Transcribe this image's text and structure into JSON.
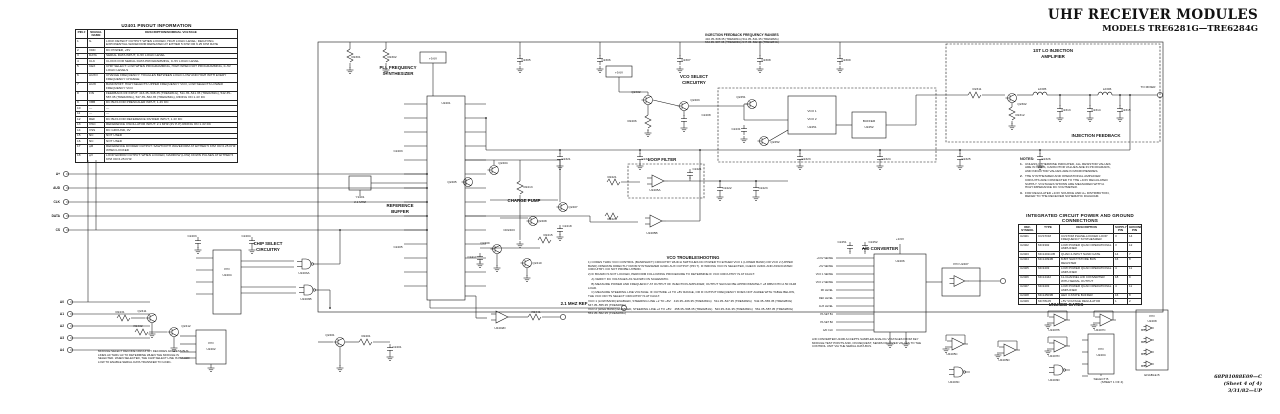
{
  "title_block": {
    "line1": "UHF RECEIVER MODULES",
    "line2": "MODELS TRE6281G—TRE6284G"
  },
  "footer": {
    "line1": "68P81088E09—C",
    "line2": "(Sheet 4 of 4)",
    "line3": "3/31/82—UP"
  },
  "pinout_table": {
    "title": "U2401 PINOUT INFORMATION",
    "columns": [
      "PIN #",
      "SIGNAL NAME",
      "DESCRIPTION/NOMINAL VOLTAGE"
    ],
    "rows": [
      [
        "1",
        "fL",
        "LOCK DETECT OUTPUT: WHEN LOCKED, HIGH LOGIC LEVEL; DECAYING EXPONENTIAL WAVEFORM REPEATED AT EITHER 5 KHZ OR 6.25 KHZ RATE"
      ],
      [
        "2",
        "VDD",
        "DC POWER, +5V"
      ],
      [
        "3",
        "DATA",
        "SERIAL DATA INPUT, 0–5V LOGIC LEVEL"
      ],
      [
        "4",
        "CLK",
        "CLOCK FOR SERIAL DATA PROGRAMMING, 0–5V LOGIC LEVEL"
      ],
      [
        "5",
        "CEX",
        "CHIP SELECT: LOW WHEN PROGRAMMING, HIGH WHEN NOT PROGRAMMING, 0–5V LOGIC LEVELS"
      ],
      [
        "6",
        "AUXO",
        "CHANGE FREQUENCY: TOGGLES BETWEEN LOGIC LOW AND HIGH WITH EVERY FREQUENCY CHANGE"
      ],
      [
        "7",
        "AUXI",
        "BANDSHIFT: HIGH SELECTS UPPER FREQUENCY VCO, LOW SELECTS LOWER FREQUENCY VCO"
      ],
      [
        "8",
        "FIN",
        "FEEDBACK RF INPUT: 416.35–508.35 (TRE6281G), 511.35–541.35 (TRE6282G), 542.35–587.35 (TRE6283G), 547.35–562.35 (TRE6284G), RIDING ON 1.4V DC"
      ],
      [
        "9",
        "VBB",
        "DC BIAS FOR PRESCALER INPUT, 1.4V DC"
      ],
      [
        "10",
        "—",
        "—"
      ],
      [
        "11",
        "—",
        "—"
      ],
      [
        "12",
        "REF",
        "DC BIAS FOR REFERENCE DIVIDER INPUT, 1.4V DC"
      ],
      [
        "13",
        "OSC",
        "REFERENCE OSCILLATOR INPUT: 2.1 MHZ (2V P-P) RIDING ON 1.4V DC"
      ],
      [
        "14",
        "VSS",
        "DC GROUND, 0V"
      ],
      [
        "15",
        "NC",
        "NOT USED"
      ],
      [
        "16",
        "NC",
        "NOT USED"
      ],
      [
        "17",
        "φR",
        "REFERENCE DIVIDER OUTPUT: SAWTOOTH WAVEFORM AT EITHER 5 KHZ OR 6.25 KHZ WHEN LOCKED"
      ],
      [
        "18",
        "φV",
        "LOOP ERROR OUTPUT: WHEN LOCKED, NARROW (LOW) DOWN PULSES AT EITHER 5 KHZ OR 6.25 KHZ"
      ]
    ]
  },
  "ic_table": {
    "title": "INTEGRATED CIRCUIT POWER AND GROUND CONNECTIONS",
    "columns": [
      "REF. SYMBOL",
      "TYPE",
      "DESCRIPTION",
      "SUPPLY PIN",
      "GROUND PIN"
    ],
    "rows": [
      [
        "U2401",
        "CUSTOM",
        "CUSTOM PHASE-LOCKED LOOP FREQUENCY SYNTHESIZER",
        "3",
        "14"
      ],
      [
        "U2402",
        "MC3302",
        "LOW POWER QUAD OPERATIONAL AMPLIFIER",
        "3",
        "12"
      ],
      [
        "U2403",
        "MC14011UB",
        "QUAD 2-INPUT NAND GATE",
        "14",
        "7"
      ],
      [
        "U2404",
        "MC14094B",
        "8-BIT SHIFT/STORE BUS REGISTER",
        "16",
        "8"
      ],
      [
        "U2405",
        "MC3403",
        "LOW POWER QUAD OPERATIONAL AMPLIFIER",
        "4",
        "11"
      ],
      [
        "U2406",
        "MC14442",
        "11-CHANNEL A/D CONVERTER WITH SERIAL OUTPUT",
        "18",
        "9"
      ],
      [
        "U2407",
        "MC3403",
        "LOW POWER QUAD OPERATIONAL AMPLIFIER",
        "4",
        "11"
      ],
      [
        "U2408",
        "MC14503B",
        "HEX 3-STATE BUFFER",
        "16",
        "8"
      ],
      [
        "U2409",
        "MC78L05",
        "+5V VOLTAGE REGULATOR",
        "1",
        "2"
      ]
    ]
  },
  "notes": {
    "title": "NOTES:",
    "items": [
      "UNLESS OTHERWISE INDICATED, ALL RESISTOR VALUES ARE IN OHMS, CAPACITOR VALUES ARE IN PICOFARADS, AND INDUCTOR VALUES ARE IN MICROHENRIES.",
      "THE SYNTHESIZER AND OPERATIONAL AMPLIFIER CIRCUITS ARE CONNECTED TO THE +9.6V REGULATED SUPPLY. VOLTAGES SHOWN ARE MEASURED WITH A HIGH IMPEDANCE DC VOLTMETER.",
      "FOR REGULATED +9.6V SOURCE AND A+ DISTRIBUTION, REFER TO THE RECEIVER SCHEMATIC DIAGRAM."
    ]
  },
  "injection_ranges": {
    "title": "INJECTION FEEDBACK FREQUENCY RANGES",
    "line1": "416.35–508.35 (TRE6281G)   511.35–541.35 (TRE6282G)",
    "line2": "542.35–587.35 (TRE6283G)   547.35–562.35 (TRE6284G)"
  },
  "vco_troubleshooting": {
    "title": "VCO TROUBLESHOOTING",
    "lines": [
      "1) CODES THRU VCO CONTROL (BANDSHIFT) CIRCUITRY WHICH SWITCHES DC POWER TO EITHER VCO 1 (LOWER BAND) OR VCO 2 (UPPER BAND) OPERATE DIRECTLY FROM SYNTHESIZER U2401 AUX OUTPUT (PIN 7). IF WRONG VCO IS SELECTED, CHECK U2401 AND ASSOCIATED CIRCUITRY. DO NOT PROBE HYBRID.",
      "2) IF BOARD IS NOT LOCKED, PERFORM FOLLOWING PROCEDURE TO DETERMINE IF VCO CIRCUITRY IS AT FAULT:",
      "    A) VERIFY DC VOLTAGES AS SHOWN ON SCHEMATIC.",
      "    B) MEASURE POWER AND FREQUENCY AT OUTPUT OF INJECTION AMPLIFIER; OUTPUT SHOULD BE APPROXIMATELY +8 DBM INTO A 50 OHM LOAD.",
      "    C) MEASURE STEERING LINE VOLTAGE. IF OUTSIDE +2 TO +8V RANGE, OR IF OUTPUT FREQUENCY DOES NOT AGREE WITH TABLE BELOW, THE VCO OR ITS SELECT CIRCUITRY IS AT FAULT.",
      "VCO 1 (LOW BAND) ENABLED, STEERING LINE +2 TO +8V:   416.35–466.35 (TRE6281G)   511.35–527.35 (TRE6282G)   542.35–565.35 (TRE6283G)   547.35–555.35 (TRE6284G)",
      "VCO 2 (HIGH BAND) ENABLED, STEERING LINE +2 TO +8V:   458.35–508.35 (TRE6281G)   523.35–541.35 (TRE6282G)   561.35–587.35 (TRE6283G)   553.35–562.35 (TRE6284G)"
    ]
  },
  "module_note": "MODULE SELECT DECODE CIRCUITRY DECODES ADDRESS BUS LINES A0 THRU A3 TO DETERMINE WHEN THE MODULE IS SELECTED. WHEN SELECTED, THE CHIP SELECT LINE IS PULLED LOW TO ENABLE SERIAL DATA TRANSFER TO U2401.",
  "adc_note": "A/D CONVERTER U2406 ACCEPTS SAMPLED ANALOG VOLTAGES FROM KEY MODULE TEST POINTS AND, ON REQUEST, SENDS DIGITIZED VALUES TO THE CONTROL UNIT VIA THE SERIAL DATA BUS.",
  "schematic": {
    "block_labels": [
      {
        "t": "PLL FREQUENCY",
        "x": 398,
        "y": 69
      },
      {
        "t": "SYNTHESIZER",
        "x": 398,
        "y": 75
      },
      {
        "t": "VCO SELECT",
        "x": 694,
        "y": 78
      },
      {
        "t": "CIRCUITRY",
        "x": 694,
        "y": 84
      },
      {
        "t": "1ST LO INJECTION",
        "x": 1053,
        "y": 52
      },
      {
        "t": "AMPLIFIER",
        "x": 1053,
        "y": 58
      },
      {
        "t": "CHARGE PUMP",
        "x": 524,
        "y": 202
      },
      {
        "t": "LOOP FILTER",
        "x": 662,
        "y": 161
      },
      {
        "t": "INJECTION FEEDBACK",
        "x": 1096,
        "y": 137
      },
      {
        "t": "REFERENCE",
        "x": 400,
        "y": 207
      },
      {
        "t": "BUFFER",
        "x": 400,
        "y": 213
      },
      {
        "t": "CHIP SELECT",
        "x": 268,
        "y": 245
      },
      {
        "t": "CIRCUITRY",
        "x": 268,
        "y": 251
      },
      {
        "t": "A/D CONVERTER",
        "x": 880,
        "y": 250
      },
      {
        "t": "UNUSED GATES",
        "x": 1066,
        "y": 306
      },
      {
        "t": "2.1 MHZ REF",
        "x": 574,
        "y": 305
      }
    ],
    "component_labels": [
      {
        "t": "C2305",
        "x": 526,
        "y": 61
      },
      {
        "t": "C2306",
        "x": 606,
        "y": 61
      },
      {
        "t": "C2307",
        "x": 686,
        "y": 61
      },
      {
        "t": "C2308",
        "x": 766,
        "y": 61
      },
      {
        "t": "C2309",
        "x": 846,
        "y": 61
      },
      {
        "t": "R2301",
        "x": 356,
        "y": 58
      },
      {
        "t": "R2302",
        "x": 392,
        "y": 58
      },
      {
        "t": "+9.6V",
        "x": 619,
        "y": 73.5
      },
      {
        "t": "+9.6V",
        "x": 433,
        "y": 59.5
      },
      {
        "t": "U2401",
        "x": 446,
        "y": 104
      },
      {
        "t": "Y2401",
        "x": 360,
        "y": 198
      },
      {
        "t": "2.1 MHZ",
        "x": 360,
        "y": 203
      },
      {
        "t": "C2403",
        "x": 398,
        "y": 152
      },
      {
        "t": "C2405",
        "x": 398,
        "y": 248
      },
      {
        "t": "Q2402",
        "x": 636,
        "y": 93
      },
      {
        "t": "Q2403",
        "x": 695,
        "y": 101
      },
      {
        "t": "R2406",
        "x": 632,
        "y": 122
      },
      {
        "t": "C2408",
        "x": 706,
        "y": 116
      },
      {
        "t": "Q2404",
        "x": 503,
        "y": 164
      },
      {
        "t": "Q2405",
        "x": 452,
        "y": 183
      },
      {
        "t": "Q2407",
        "x": 573,
        "y": 208
      },
      {
        "t": "Q2408",
        "x": 542,
        "y": 222
      },
      {
        "t": "Q2409",
        "x": 485,
        "y": 244
      },
      {
        "t": "Q2410",
        "x": 537,
        "y": 264
      },
      {
        "t": "R2413",
        "x": 528,
        "y": 188
      },
      {
        "t": "R2415",
        "x": 548,
        "y": 236
      },
      {
        "t": "CR2403",
        "x": 509,
        "y": 231
      },
      {
        "t": "C2417",
        "x": 472,
        "y": 258
      },
      {
        "t": "C2418",
        "x": 567,
        "y": 227
      },
      {
        "t": "U2405A",
        "x": 655,
        "y": 191
      },
      {
        "t": "R2421",
        "x": 612,
        "y": 178
      },
      {
        "t": "C2421",
        "x": 697,
        "y": 170
      },
      {
        "t": "C2422",
        "x": 727,
        "y": 189
      },
      {
        "t": "C2423",
        "x": 763,
        "y": 189
      },
      {
        "t": "U2405B",
        "x": 652,
        "y": 234
      },
      {
        "t": "R2424",
        "x": 612,
        "y": 220
      },
      {
        "t": "VCO 1",
        "x": 812,
        "y": 112
      },
      {
        "t": "VCO 2",
        "x": 812,
        "y": 120
      },
      {
        "t": "U2451",
        "x": 812,
        "y": 128
      },
      {
        "t": "BUFFER",
        "x": 869,
        "y": 122
      },
      {
        "t": "U2452",
        "x": 869,
        "y": 128
      },
      {
        "t": "Q2451",
        "x": 741,
        "y": 98
      },
      {
        "t": "Q2452",
        "x": 775,
        "y": 143
      },
      {
        "t": "C2431",
        "x": 736,
        "y": 130
      },
      {
        "t": "R2311",
        "x": 977,
        "y": 90
      },
      {
        "t": "Q2302",
        "x": 1022,
        "y": 105
      },
      {
        "t": "L2305",
        "x": 1042,
        "y": 90
      },
      {
        "t": "L2306",
        "x": 1107,
        "y": 90
      },
      {
        "t": "C2313",
        "x": 1066,
        "y": 111
      },
      {
        "t": "C2314",
        "x": 1096,
        "y": 111
      },
      {
        "t": "C2315",
        "x": 1126,
        "y": 111
      },
      {
        "t": "R2312",
        "x": 1020,
        "y": 116
      },
      {
        "t": "TO MIXER",
        "x": 1148,
        "y": 88
      },
      {
        "t": "C2321",
        "x": 566,
        "y": 160
      },
      {
        "t": "C2322",
        "x": 646,
        "y": 160
      },
      {
        "t": "C2323",
        "x": 806,
        "y": 160
      },
      {
        "t": "C2324",
        "x": 886,
        "y": 160
      },
      {
        "t": "C2325",
        "x": 966,
        "y": 160
      },
      {
        "t": "C2326",
        "x": 1046,
        "y": 160
      },
      {
        "t": "U2403A",
        "x": 304,
        "y": 274
      },
      {
        "t": "U2403B",
        "x": 306,
        "y": 300
      },
      {
        "t": "P/O",
        "x": 227,
        "y": 270
      },
      {
        "t": "U2404",
        "x": 227,
        "y": 276
      },
      {
        "t": "C2403",
        "x": 192,
        "y": 237
      },
      {
        "t": "C2404",
        "x": 246,
        "y": 237
      },
      {
        "t": "Q2411",
        "x": 142,
        "y": 312
      },
      {
        "t": "Q2412",
        "x": 186,
        "y": 327
      },
      {
        "t": "R2431",
        "x": 120,
        "y": 313
      },
      {
        "t": "R2432",
        "x": 138,
        "y": 327
      },
      {
        "t": "P/O",
        "x": 211,
        "y": 344
      },
      {
        "t": "U2402",
        "x": 211,
        "y": 350
      },
      {
        "t": "Q2401",
        "x": 330,
        "y": 336
      },
      {
        "t": "R2401",
        "x": 366,
        "y": 337
      },
      {
        "t": "C2401",
        "x": 397,
        "y": 348
      },
      {
        "t": "U2402D",
        "x": 500,
        "y": 329
      },
      {
        "t": "R2441",
        "x": 536,
        "y": 313
      },
      {
        "t": "U2406",
        "x": 900,
        "y": 262
      },
      {
        "t": "C2451",
        "x": 842,
        "y": 243
      },
      {
        "t": "C2452",
        "x": 873,
        "y": 243
      },
      {
        "t": "+9.6V",
        "x": 900,
        "y": 240
      },
      {
        "t": "P/O U2407",
        "x": 961,
        "y": 265
      },
      {
        "t": "U2407B",
        "x": 1054,
        "y": 331
      },
      {
        "t": "U2407C",
        "x": 1100,
        "y": 331
      },
      {
        "t": "U2407D",
        "x": 1054,
        "y": 357
      },
      {
        "t": "U2403D",
        "x": 1054,
        "y": 381
      },
      {
        "t": "P/O",
        "x": 1101,
        "y": 350
      },
      {
        "t": "U2404",
        "x": 1101,
        "y": 356
      },
      {
        "t": "SELECT B",
        "x": 1101,
        "y": 380
      },
      {
        "t": "P/O",
        "x": 1152,
        "y": 317
      },
      {
        "t": "U2408",
        "x": 1152,
        "y": 322
      },
      {
        "t": "B1",
        "x": 1143,
        "y": 331
      },
      {
        "t": "B2",
        "x": 1143,
        "y": 343
      },
      {
        "t": "B3",
        "x": 1143,
        "y": 355
      },
      {
        "t": "B4",
        "x": 1143,
        "y": 367
      },
      {
        "t": "ENABLE B",
        "x": 1152,
        "y": 376
      },
      {
        "t": "(SHEET 1 OF 4)",
        "x": 1112,
        "y": 383
      },
      {
        "t": "U2405C",
        "x": 952,
        "y": 355
      },
      {
        "t": "U2405D",
        "x": 1004,
        "y": 361
      },
      {
        "t": "U2403C",
        "x": 954,
        "y": 383
      }
    ],
    "left_terminals": [
      {
        "t": "A+",
        "y": 174
      },
      {
        "t": "AUD",
        "y": 188
      },
      {
        "t": "CLK",
        "y": 202
      },
      {
        "t": "DATA",
        "y": 216
      },
      {
        "t": "CS",
        "y": 230
      }
    ],
    "addr_terminals": [
      {
        "t": "A0",
        "y": 302
      },
      {
        "t": "A1",
        "y": 314
      },
      {
        "t": "A2",
        "y": 326
      },
      {
        "t": "A3",
        "y": 338
      },
      {
        "t": "A4",
        "y": 350
      }
    ],
    "adc_pin_labels": [
      "+9.6V SENSE",
      "+5V SENSE",
      "VCO 1 SENSE",
      "VCO 2 SENSE",
      "RF LEVEL",
      "REF LEVEL",
      "AUX LEVEL",
      "PA SET B1",
      "PA SET B2",
      "A/D CLK"
    ]
  }
}
